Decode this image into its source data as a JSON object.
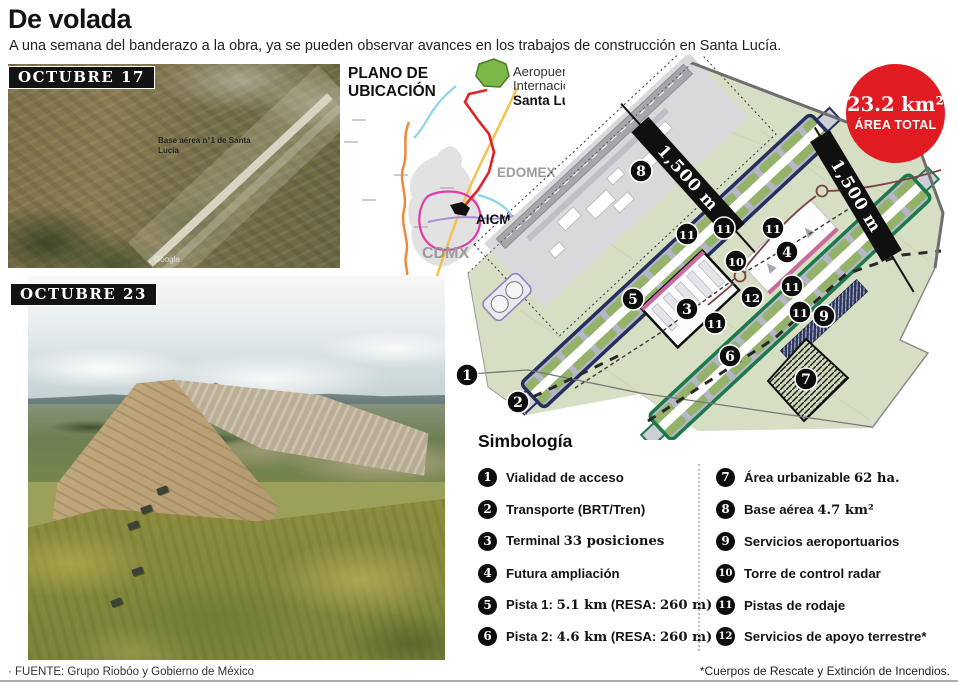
{
  "header": {
    "title": "De volada",
    "subtitle": "A una semana del banderazo a la obra, ya se pueden observar avances en los trabajos de construcción en Santa Lucía."
  },
  "photos": {
    "photo1_label": "OCTUBRE 17",
    "photo1_caption": "Base aérea n°1 de Santa Lucía",
    "photo1_watermark": "Google",
    "photo2_label": "OCTUBRE 23"
  },
  "location_map": {
    "title_line1": "PLANO DE",
    "title_line2": "UBICACIÓN",
    "airport_line1": "Aeropuerto",
    "airport_line2": "Internacional",
    "airport_line3": "Santa Lucía",
    "edomex": "EDOMEX",
    "cdmx": "CDMX",
    "aicm": "AICM"
  },
  "badge": {
    "value": "23.2 km²",
    "label": "ÁREA TOTAL",
    "color": "#e11b22"
  },
  "plan": {
    "distance_label_1": "1,500 m",
    "distance_label_2": "1,500 m",
    "colors": {
      "site": "#d6dfc4",
      "runway1_border": "#252f5e",
      "runway2_border": "#1c7a4a"
    },
    "markers": [
      {
        "n": "1",
        "x": 467,
        "y": 375
      },
      {
        "n": "2",
        "x": 518,
        "y": 402
      },
      {
        "n": "3",
        "x": 687,
        "y": 309
      },
      {
        "n": "4",
        "x": 787,
        "y": 252
      },
      {
        "n": "5",
        "x": 633,
        "y": 299
      },
      {
        "n": "6",
        "x": 730,
        "y": 356
      },
      {
        "n": "7",
        "x": 806,
        "y": 379
      },
      {
        "n": "8",
        "x": 641,
        "y": 171
      },
      {
        "n": "9",
        "x": 824,
        "y": 316
      },
      {
        "n": "10",
        "x": 736,
        "y": 261
      },
      {
        "n": "11",
        "x": 687,
        "y": 234
      },
      {
        "n": "11",
        "x": 724,
        "y": 228
      },
      {
        "n": "11",
        "x": 773,
        "y": 228
      },
      {
        "n": "11",
        "x": 792,
        "y": 286
      },
      {
        "n": "11",
        "x": 715,
        "y": 323
      },
      {
        "n": "11",
        "x": 800,
        "y": 312
      },
      {
        "n": "12",
        "x": 752,
        "y": 297
      }
    ]
  },
  "legend": {
    "title": "Simbología",
    "items": [
      {
        "num": "1",
        "s1": "Vialidad de acceso"
      },
      {
        "num": "2",
        "s1": "Transporte (BRT/Tren)"
      },
      {
        "num": "3",
        "s1": "Terminal ",
        "s2": "33 posiciones"
      },
      {
        "num": "4",
        "s1": "Futura ampliación"
      },
      {
        "num": "5",
        "s1": "Pista 1: ",
        "s2": "5.1 km",
        "s3": " (RESA: ",
        "s4": "260 m)"
      },
      {
        "num": "6",
        "s1": "Pista 2: ",
        "s2": "4.6 km",
        "s3": " (RESA: ",
        "s4": "260 m)"
      },
      {
        "num": "7",
        "s1": "Área urbanizable ",
        "s2": "62 ha."
      },
      {
        "num": "8",
        "s1": "Base aérea ",
        "s2": "4.7 km²"
      },
      {
        "num": "9",
        "s1": "Servicios aeroportuarios"
      },
      {
        "num": "10",
        "s1": "Torre de control radar"
      },
      {
        "num": "11",
        "s1": "Pistas de rodaje"
      },
      {
        "num": "12",
        "s1": "Servicios de apoyo terrestre*"
      }
    ]
  },
  "footer": {
    "source": "· FUENTE: Grupo Riobóo y Gobierno de México",
    "note": "*Cuerpos de Rescate y Extinción de Incendios."
  }
}
